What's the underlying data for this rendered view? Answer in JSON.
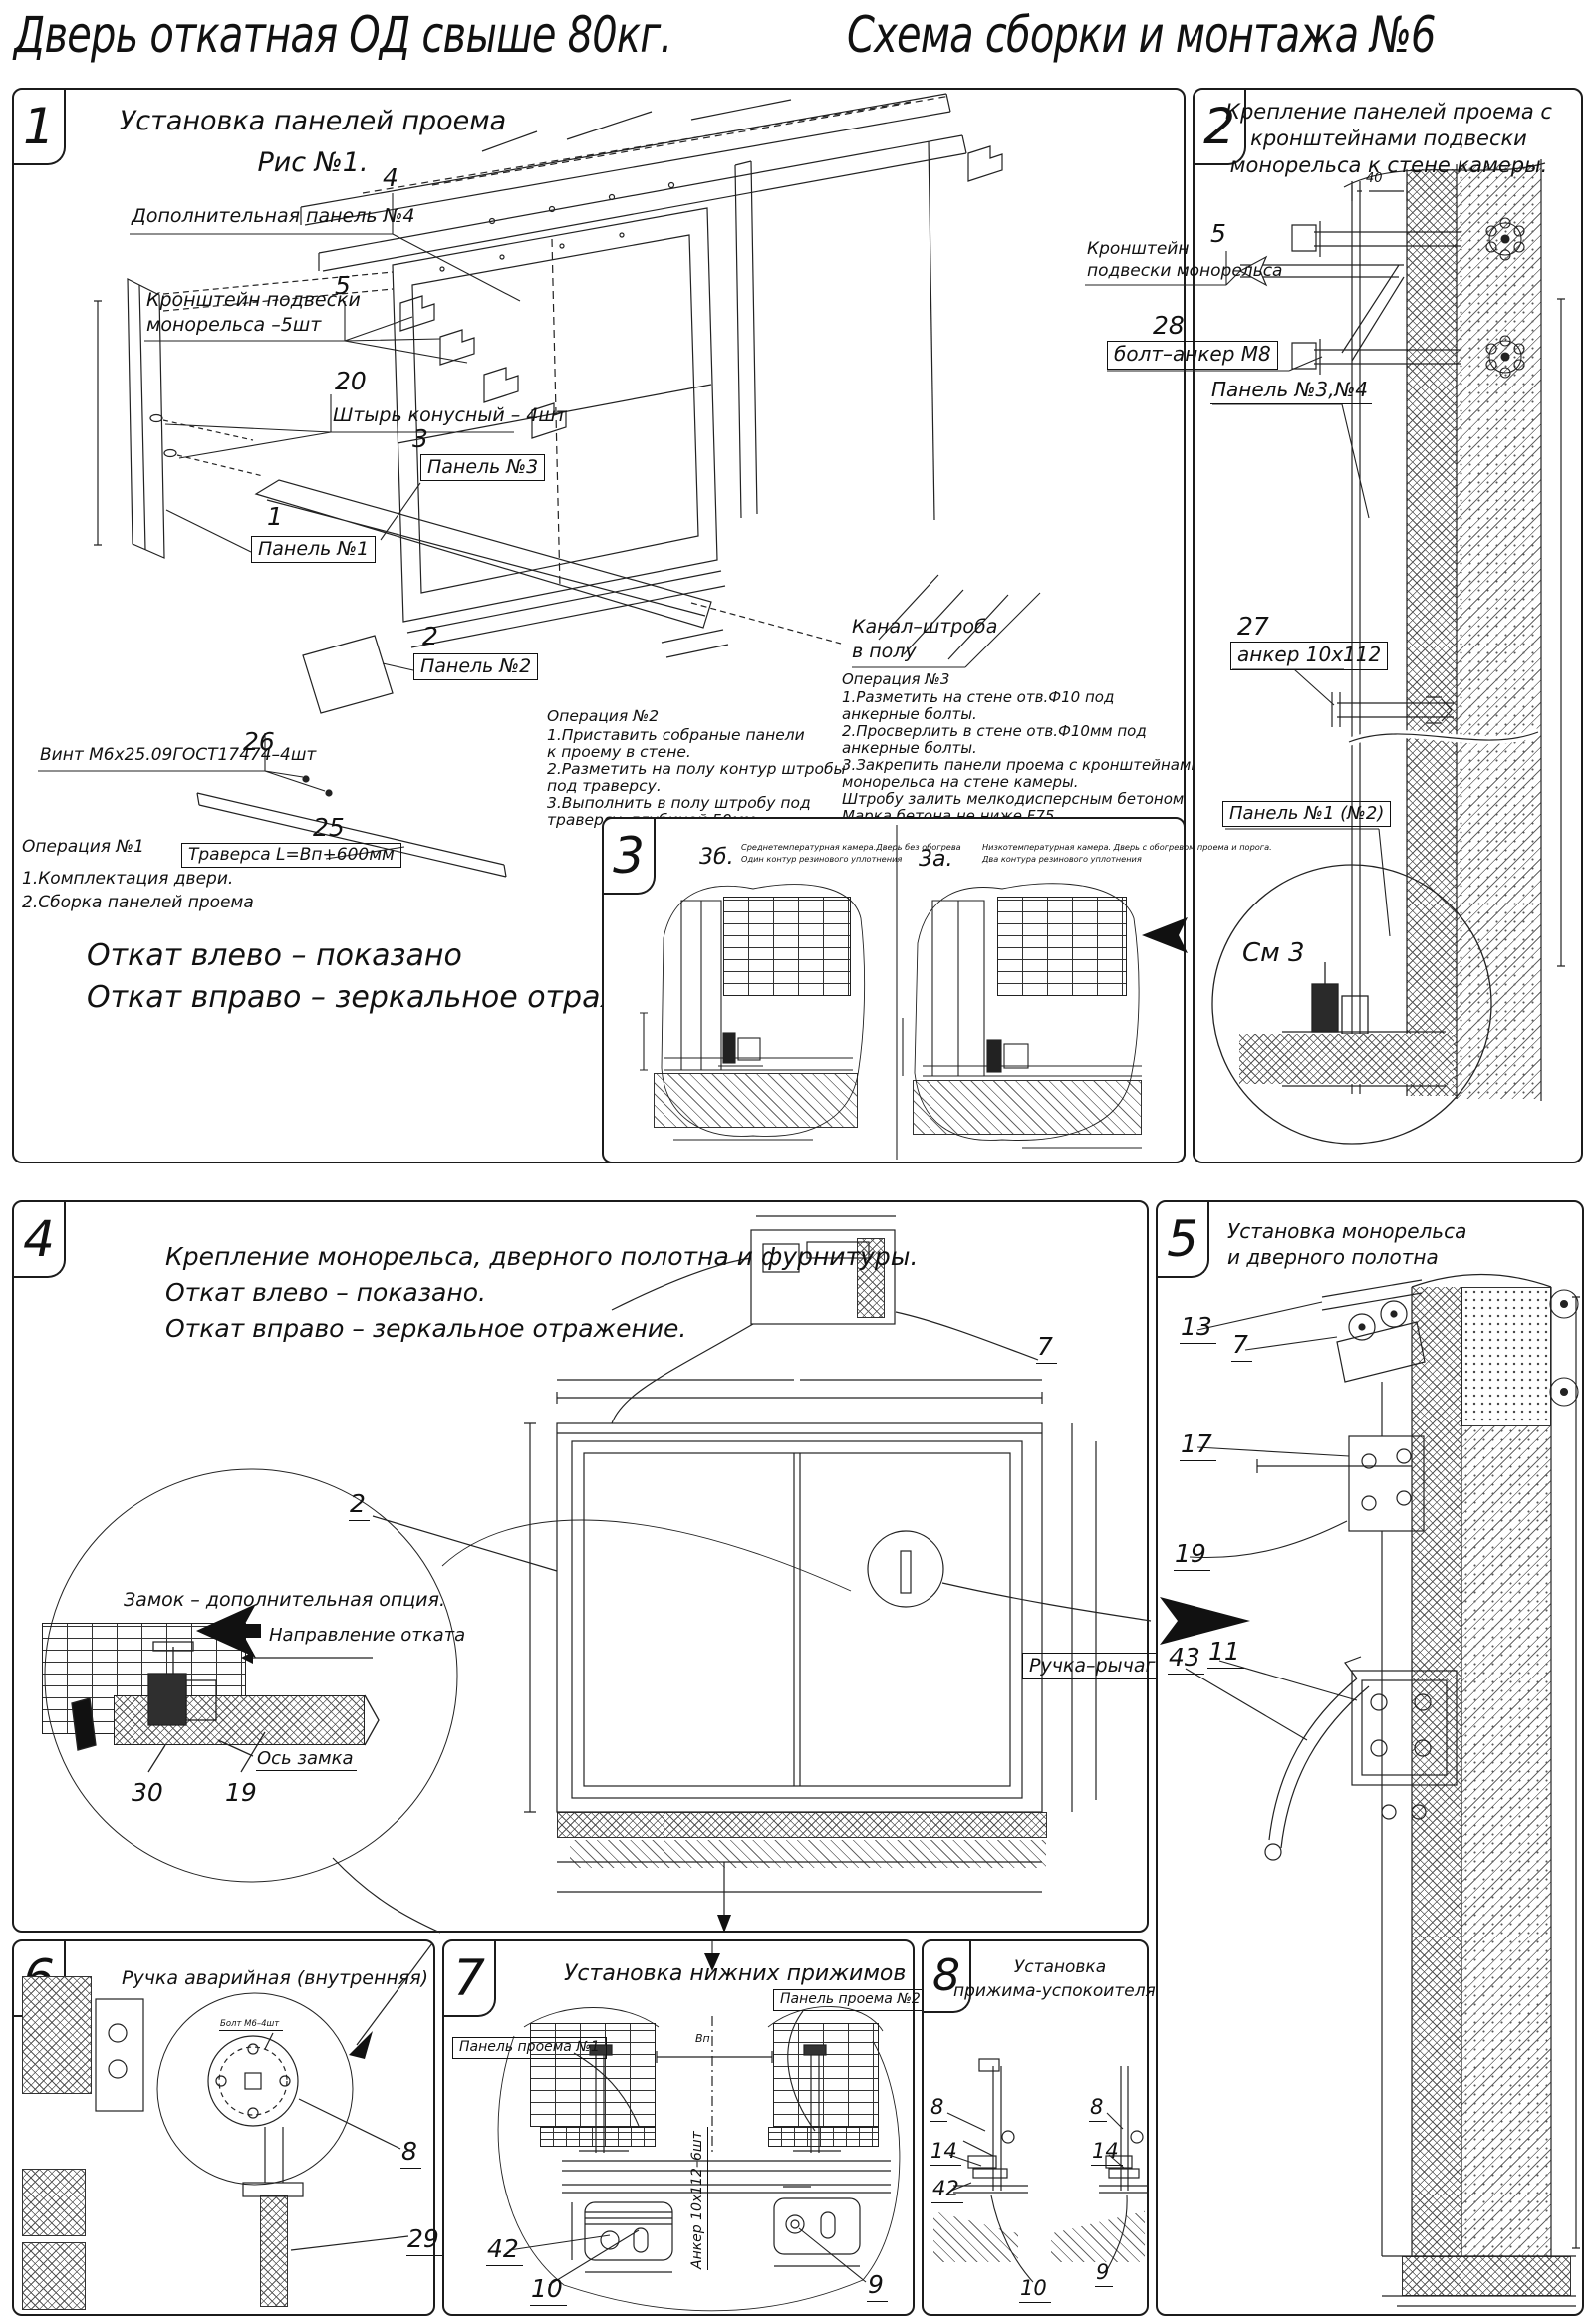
{
  "title": {
    "left": "Дверь откатная ОД свыше 80кг.",
    "right": "Схема сборки и монтажа №6"
  },
  "p1": {
    "num": "1",
    "header1": "Установка панелей проема",
    "header2": "Рис №1.",
    "c4n": "4",
    "c4": "Дополнительная панель №4",
    "c5n": "5",
    "c5a": "Кронштейн подвески",
    "c5b": "монорельса –5шт",
    "c20n": "20",
    "c20": "Штырь конусный – 4шт",
    "c3n": "3",
    "c3": "Панель №3",
    "c1n": "1",
    "c1": "Панель №1",
    "c2n": "2",
    "c2": "Панель №2",
    "c26n": "26",
    "c26": "Винт М6х25.09ГОСТ17474–4шт",
    "c25n": "25",
    "c25": "Траверса  L=Вп+600мм",
    "op1": [
      "Операция №1",
      "1.Комплектация двери.",
      "2.Сборка панелей проема"
    ],
    "op2": [
      "Операция №2",
      "1.Приставить собраные панели",
      "к проему в стене.",
      "2.Разметить на полу контур штробы",
      "под траверсу.",
      "3.Выполнить в полу штробу под",
      "траверсу, глубиной 50мм."
    ],
    "kanal1": "Канал–штроба",
    "kanal2": "в полу",
    "op3": [
      "Операция №3",
      "1.Разметить на стене отв.Ф10 под",
      "анкерные болты.",
      "2.Просверлить в стене отв.Ф10мм   под",
      "анкерные болты.",
      "3.Закрепить панели проема с кронштейнами подвески",
      "монорельса на стене камеры.",
      "Штробу залить мелкодисперсным бетоном",
      "Марка бетона не ниже   F75."
    ],
    "note1": "Откат влево – показано",
    "note2": "Откат вправо – зеркальное отражение."
  },
  "p2": {
    "num": "2",
    "header": [
      "Крепление панелей проема с",
      "кронштейнами  подвески",
      "монорельса к стене камеры."
    ],
    "dim40": "40",
    "c5n": "5",
    "c5a": "Кронштейн",
    "c5b": "подвески монорельса",
    "c28n": "28",
    "c28": "болт–анкер М8",
    "p34": "Панель №3,№4",
    "c27n": "27",
    "c27": "анкер 10х112",
    "p12": "Панель №1 (№2)",
    "see3": "См 3"
  },
  "p3": {
    "num": "3",
    "figb_n": "3б.",
    "figb": [
      "Среднетемпературная камера.Дверь без обогрева",
      "Один контур резинового уплотнения"
    ],
    "figa_n": "3а.",
    "figa": [
      "Низкотемпературная камера. Дверь с обогревом проема и порога.",
      "Два контура резинового уплотнения"
    ]
  },
  "p4": {
    "num": "4",
    "header": [
      "Крепление монорельса, дверного полотна и фурнитуры.",
      "Откат влево – показано.",
      "Откат вправо – зеркальное отражение."
    ],
    "n2": "2",
    "n7": "7",
    "lock": "Замок – дополнительная опция.",
    "dir": "Направление отката",
    "axis": "Ось замка",
    "n30": "30",
    "n19": "19"
  },
  "p5": {
    "num": "5",
    "header": [
      "Установка монорельса",
      "и дверного полотна"
    ],
    "n13": "13",
    "n7": "7",
    "n17": "17",
    "n19": "19",
    "n43": "43",
    "n11": "11",
    "handle": "Ручка–рычаг"
  },
  "p6": {
    "num": "6",
    "header": "Ручка аварийная (внутренняя)",
    "bolt": "Болт М6–4шт",
    "n8": "8",
    "n29": "29"
  },
  "p7": {
    "num": "7",
    "header": "Установка нижних прижимов",
    "pan2": "Панель проема №2",
    "pan1": "Панель проема №1",
    "anchor": "Анкер  10х112–6шт",
    "vp": "Вп",
    "n42": "42",
    "n10": "10",
    "n9": "9"
  },
  "p8": {
    "num": "8",
    "header": [
      "Установка",
      "прижима-успокоителя"
    ],
    "n8a": "8",
    "n14a": "14",
    "n42": "42",
    "n10": "10",
    "n8b": "8",
    "n14b": "14",
    "n9": "9"
  }
}
